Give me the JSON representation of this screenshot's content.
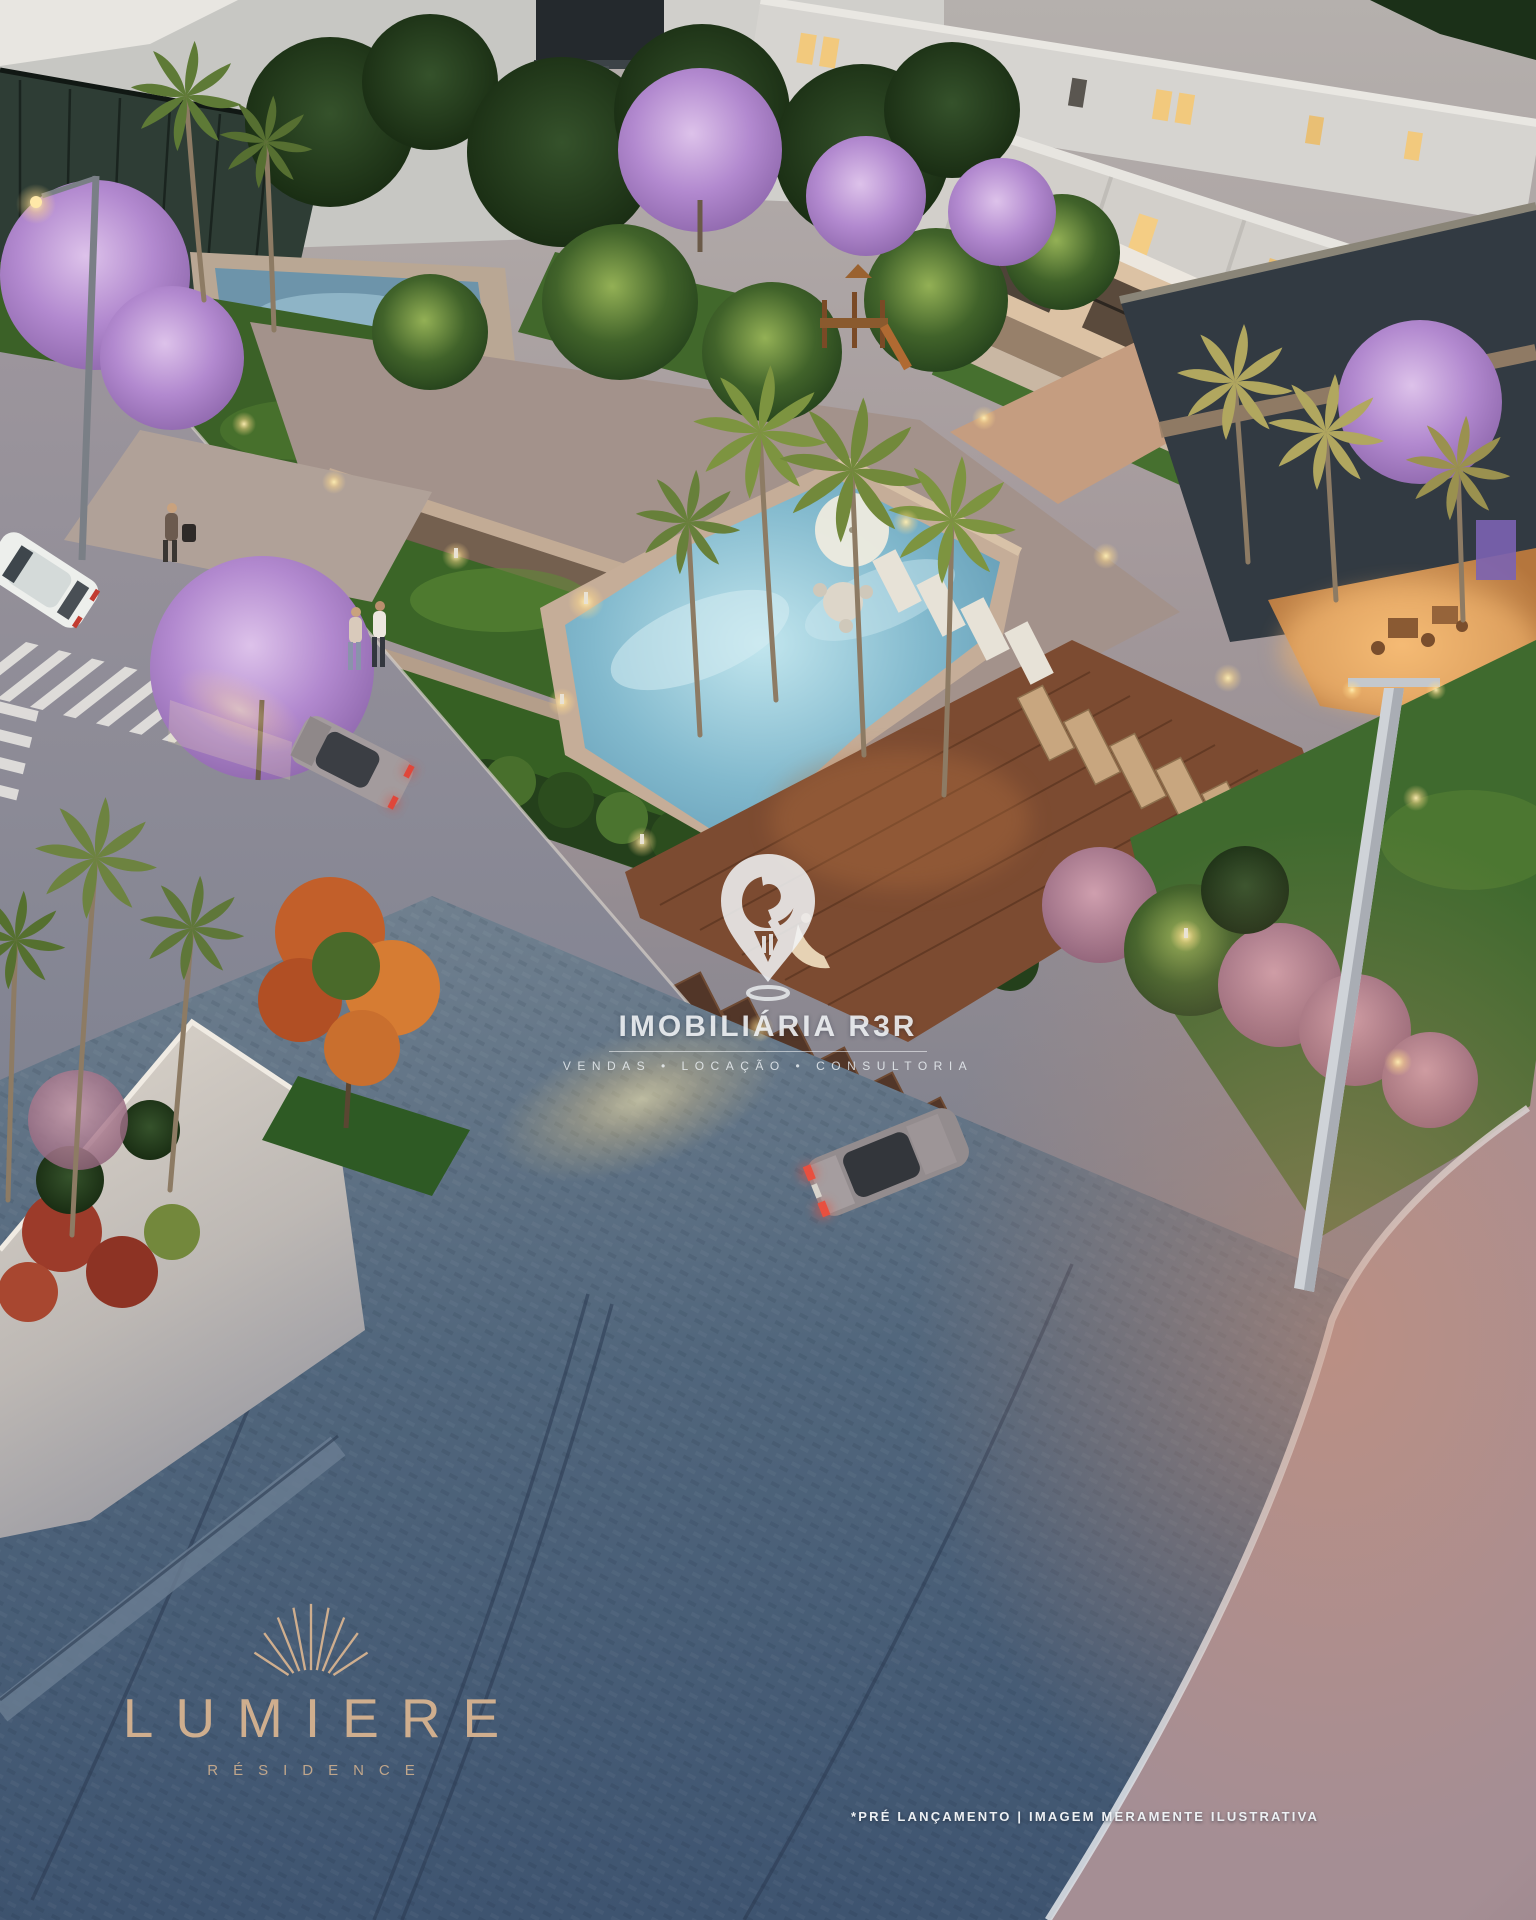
{
  "brand_watermark": {
    "name": "IMOBILIÁRIA R3R",
    "tagline": "VENDAS • LOCAÇÃO • CONSULTORIA",
    "icon": "map-pin-keyhole-icon",
    "color": "#f2f5f7"
  },
  "development_logo": {
    "name": "LUMIERE",
    "subtitle": "RÉSIDENCE",
    "icon": "sunburst-rays-icon",
    "color": "#cfae8e"
  },
  "disclaimer": "*PRÉ LANÇAMENTO | IMAGEM MERAMENTE ILUSTRATIVA",
  "scene": {
    "type": "architectural-dusk-render",
    "subject": "residential condominium aerial view with pool, clubhouse, gardens, streets and townhouses",
    "palette": {
      "pavement_dusk_blue": "#4c617a",
      "sidewalk_rose": "#b49a94",
      "grass_green": "#3f6a2e",
      "jacaranda_purple": "#bb96d4",
      "pool_water": "#86bdd2",
      "deck_wood": "#7c4b31",
      "building_white": "#d6d4d0",
      "window_glow": "#f4cd84"
    }
  }
}
